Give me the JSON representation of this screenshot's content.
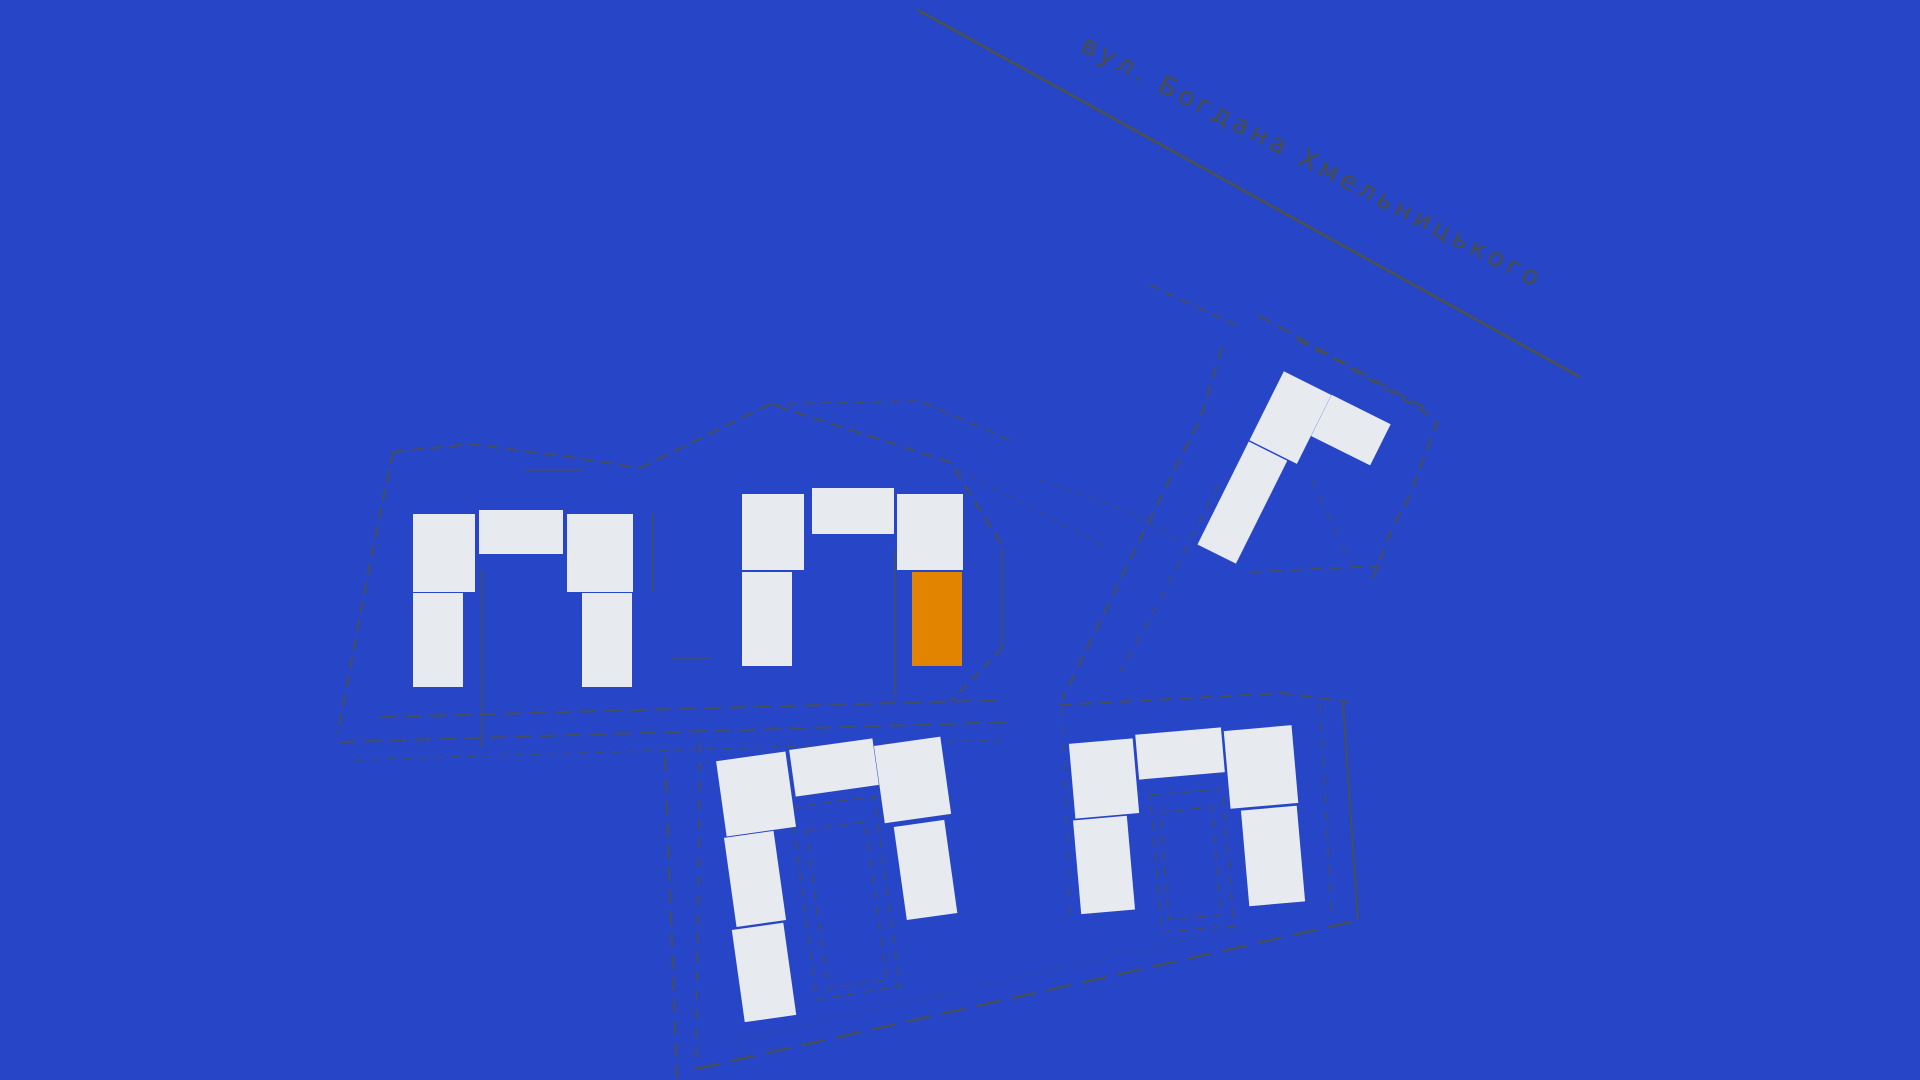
{
  "map": {
    "street": {
      "name": "вул. Богдана Хмельницького"
    },
    "road": {
      "x1": 918,
      "y1": 10,
      "x2": 1580,
      "y2": 377,
      "color": "#4f5444",
      "width": 2.5,
      "opacity": 0.95
    },
    "colors": {
      "background": "#2745C7",
      "building": "#E7EBF0",
      "building_highlight": "#E28400",
      "boundary": "#4C5244"
    },
    "clusters": [
      {
        "id": "cluster-left",
        "blocks": [
          {
            "cx": 444,
            "cy": 553,
            "w": 64,
            "h": 79,
            "rot": 0,
            "state": "default"
          },
          {
            "cx": 521,
            "cy": 532,
            "w": 85,
            "h": 46,
            "rot": 0,
            "state": "default"
          },
          {
            "cx": 600,
            "cy": 553,
            "w": 67,
            "h": 79,
            "rot": 0,
            "state": "default"
          },
          {
            "cx": 438,
            "cy": 640,
            "w": 51,
            "h": 95,
            "rot": 0,
            "state": "default"
          },
          {
            "cx": 607,
            "cy": 640,
            "w": 52,
            "h": 95,
            "rot": 0,
            "state": "default"
          }
        ]
      },
      {
        "id": "cluster-middle",
        "blocks": [
          {
            "cx": 773,
            "cy": 532,
            "w": 63,
            "h": 78,
            "rot": 0,
            "state": "default"
          },
          {
            "cx": 853,
            "cy": 511,
            "w": 84,
            "h": 48,
            "rot": 0,
            "state": "default"
          },
          {
            "cx": 930,
            "cy": 532,
            "w": 67,
            "h": 77,
            "rot": 0,
            "state": "default"
          },
          {
            "cx": 767,
            "cy": 619,
            "w": 51,
            "h": 96,
            "rot": 0,
            "state": "default"
          },
          {
            "cx": 937,
            "cy": 619,
            "w": 52,
            "h": 96,
            "rot": 0,
            "state": "highlight"
          }
        ]
      },
      {
        "id": "cluster-top-right",
        "blocks": [
          {
            "cx": 1290,
            "cy": 417,
            "w": 54,
            "h": 78,
            "rot": 26.5,
            "state": "default"
          },
          {
            "cx": 1351,
            "cy": 430,
            "w": 67,
            "h": 47,
            "rot": 26.5,
            "state": "default"
          },
          {
            "cx": 1242,
            "cy": 502,
            "w": 44,
            "h": 116,
            "rot": 26.5,
            "state": "default"
          }
        ]
      },
      {
        "id": "cluster-bottom-middle",
        "blocks": [
          {
            "cx": 756,
            "cy": 794,
            "w": 71,
            "h": 77,
            "rot": -8,
            "state": "default"
          },
          {
            "cx": 834,
            "cy": 767,
            "w": 85,
            "h": 48,
            "rot": -8,
            "state": "default"
          },
          {
            "cx": 912,
            "cy": 780,
            "w": 68,
            "h": 79,
            "rot": -8,
            "state": "default"
          },
          {
            "cx": 755,
            "cy": 879,
            "w": 51,
            "h": 91,
            "rot": -8,
            "state": "default"
          },
          {
            "cx": 764,
            "cy": 972,
            "w": 53,
            "h": 94,
            "rot": -8,
            "state": "default"
          },
          {
            "cx": 925,
            "cy": 870,
            "w": 52,
            "h": 95,
            "rot": -8,
            "state": "default"
          }
        ]
      },
      {
        "id": "cluster-bottom-right",
        "blocks": [
          {
            "cx": 1104,
            "cy": 778,
            "w": 65,
            "h": 76,
            "rot": -5,
            "state": "default"
          },
          {
            "cx": 1180,
            "cy": 753,
            "w": 87,
            "h": 46,
            "rot": -5,
            "state": "default"
          },
          {
            "cx": 1261,
            "cy": 767,
            "w": 69,
            "h": 79,
            "rot": -5,
            "state": "default"
          },
          {
            "cx": 1104,
            "cy": 865,
            "w": 55,
            "h": 95,
            "rot": -5,
            "state": "default"
          },
          {
            "cx": 1273,
            "cy": 856,
            "w": 57,
            "h": 97,
            "rot": -5,
            "state": "default"
          }
        ]
      }
    ],
    "boundaries": [
      {
        "points": "393,452 470,444 570,457 640,468",
        "dash": "12 7",
        "width": 2,
        "opacity": 0.85
      },
      {
        "points": "393,452 370,563 338,733",
        "dash": "12 7",
        "width": 2,
        "opacity": 0.85
      },
      {
        "points": "380,717 1005,700",
        "dash": "16 9",
        "width": 2,
        "opacity": 0.85
      },
      {
        "points": "340,742 1010,722",
        "dash": "16 9",
        "width": 2,
        "opacity": 0.8
      },
      {
        "points": "355,760 1000,740",
        "dash": "8 8",
        "width": 1.5,
        "opacity": 0.7
      },
      {
        "points": "665,757 677,1078",
        "dash": "14 8",
        "width": 2,
        "opacity": 0.85
      },
      {
        "points": "700,743 696,1069",
        "dash": "10 9",
        "width": 1.8,
        "opacity": 0.8
      },
      {
        "points": "696,1069 1360,920",
        "dash": "24 12",
        "width": 2.2,
        "opacity": 0.9
      },
      {
        "points": "729,1042 1240,928",
        "dash": "2 6",
        "width": 1.2,
        "opacity": 0.6
      },
      {
        "points": "640,468 770,404 950,462 1004,548",
        "dash": "12 7",
        "width": 2,
        "opacity": 0.85
      },
      {
        "points": "770,404 920,401 1010,440",
        "dash": "10 7",
        "width": 1.8,
        "opacity": 0.75
      },
      {
        "points": "1002,548 1002,648",
        "dash": "",
        "width": 1.5,
        "opacity": 0.8
      },
      {
        "points": "1002,648 950,702",
        "dash": "10 7",
        "width": 2,
        "opacity": 0.8
      },
      {
        "points": "895,550 895,697",
        "dash": "",
        "width": 1.5,
        "opacity": 0.8
      },
      {
        "points": "482,569 482,748",
        "dash": "",
        "width": 1.5,
        "opacity": 0.8
      },
      {
        "points": "653,513 653,592",
        "dash": "",
        "width": 1.5,
        "opacity": 0.8
      },
      {
        "points": "525,470 582,470",
        "dash": "",
        "width": 1.5,
        "opacity": 0.7
      },
      {
        "points": "672,658 710,658",
        "dash": "",
        "width": 1.5,
        "opacity": 0.7
      },
      {
        "points": "1222,347 1200,420 1180,458 1125,570 1075,673 1062,700",
        "dash": "12 8",
        "width": 2,
        "opacity": 0.85
      },
      {
        "points": "1297,340 1333,358 1422,410 1437,423 1410,495 1392,528 1373,578",
        "dash": "12 8",
        "width": 2,
        "opacity": 0.85
      },
      {
        "points": "1250,572 1380,566",
        "dash": "12 8",
        "width": 1.8,
        "opacity": 0.8
      },
      {
        "points": "1150,285 1242,328",
        "dash": "10 7",
        "width": 1.8,
        "opacity": 0.8
      },
      {
        "points": "1258,315 1425,408",
        "dash": "14 8",
        "width": 2,
        "opacity": 0.85
      },
      {
        "points": "1060,705 1283,693 1348,702",
        "dash": "12 8",
        "width": 2,
        "opacity": 0.85
      },
      {
        "points": "1343,703 1358,920",
        "dash": "",
        "width": 2,
        "opacity": 0.85
      },
      {
        "points": "1320,703 1332,918",
        "dash": "10 8",
        "width": 1.5,
        "opacity": 0.7
      },
      {
        "points": "1062,708 1070,920",
        "dash": "8 10",
        "width": 1.5,
        "opacity": 0.6
      },
      {
        "points": "791,808 874,796 900,986 817,1000 791,808",
        "dash": "9 7",
        "width": 1.5,
        "opacity": 0.75
      },
      {
        "points": "806,830 865,822 887,980 828,988 806,830",
        "dash": "9 7",
        "width": 1.5,
        "opacity": 0.75
      },
      {
        "points": "1150,795 1222,789 1234,926 1162,932 1150,795",
        "dash": "9 7",
        "width": 1.5,
        "opacity": 0.75
      },
      {
        "points": "1160,812 1212,807 1221,915 1169,919 1160,812",
        "dash": "9 7",
        "width": 1.5,
        "opacity": 0.75
      },
      {
        "points": "1218,485 1160,600 1120,672",
        "dash": "9 8",
        "width": 1.5,
        "opacity": 0.7
      },
      {
        "points": "1312,480 1352,566",
        "dash": "8 10",
        "width": 1.5,
        "opacity": 0.6
      },
      {
        "points": "958,470 1108,548",
        "dash": "7 6",
        "width": 1.2,
        "opacity": 0.55
      },
      {
        "points": "1040,480 1125,510 1180,540",
        "dash": "7 6",
        "width": 1.2,
        "opacity": 0.55
      }
    ]
  }
}
